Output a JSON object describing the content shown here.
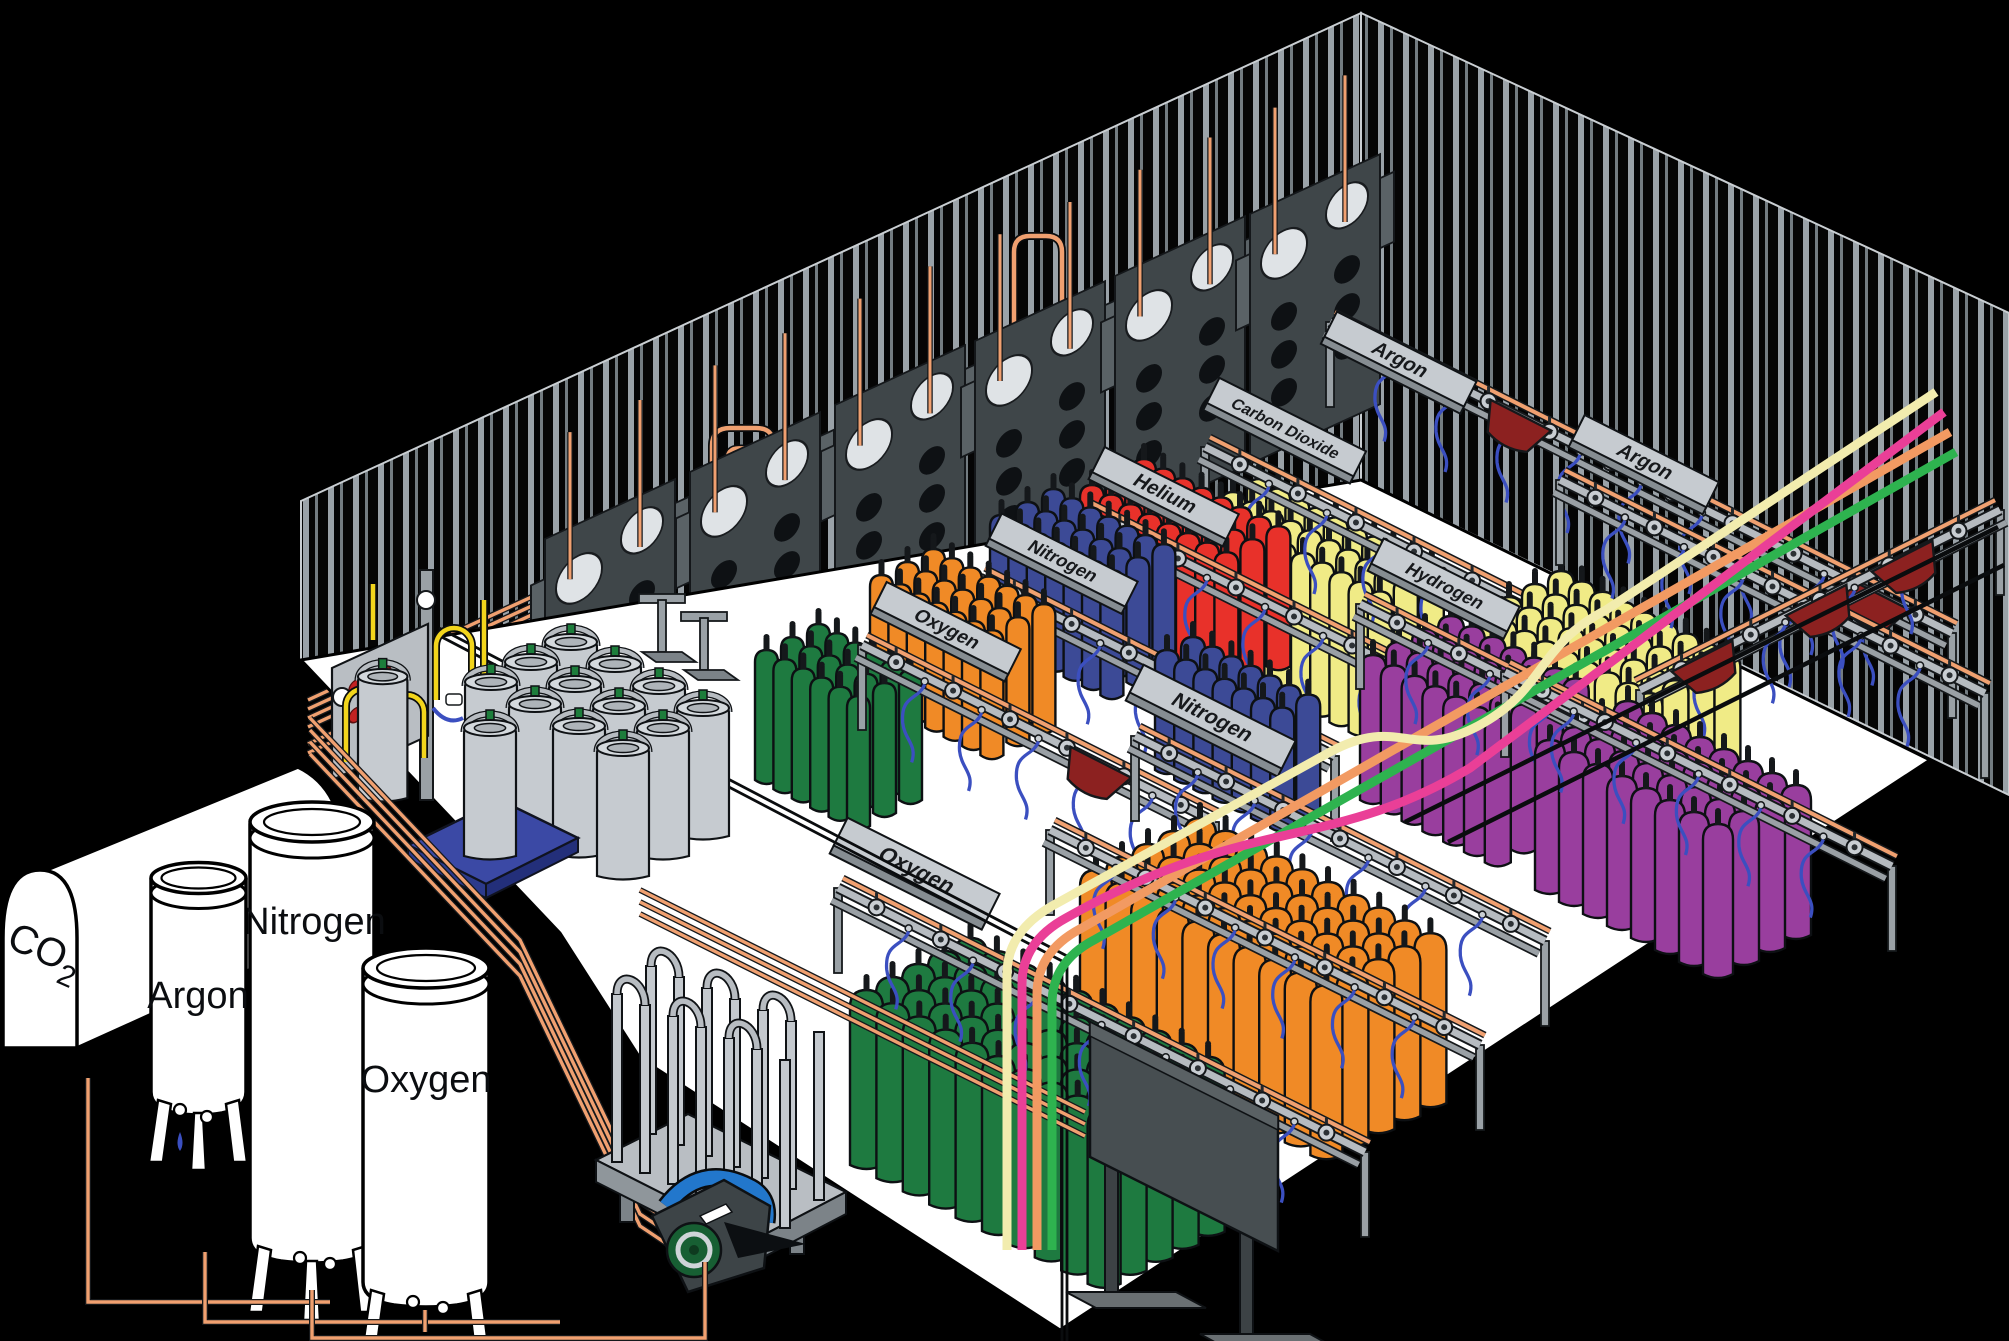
{
  "storage_tanks": {
    "co2": {
      "label_main": "CO",
      "label_sub": "2"
    },
    "argon": {
      "label": "Argon"
    },
    "nitrogen": {
      "label": "Nitrogen"
    },
    "oxygen": {
      "label": "Oxygen"
    }
  },
  "rack_signs": {
    "argon_top": {
      "label": "Argon"
    },
    "carbon_dioxide": {
      "label": "Carbon Dioxide"
    },
    "helium": {
      "label": "Helium"
    },
    "nitrogen_upper": {
      "label": "Nitrogen"
    },
    "oxygen_upper": {
      "label": "Oxygen"
    },
    "argon_right": {
      "label": "Argon"
    },
    "hydrogen": {
      "label": "Hydrogen"
    },
    "nitrogen_middle": {
      "label": "Nitrogen"
    },
    "oxygen_front": {
      "label": "Oxygen"
    }
  },
  "colors": {
    "background": "#000000",
    "floor": "#ffffff",
    "wall_stripe_light": "#9aa2a8",
    "wall_stripe_dark": "#737c81",
    "copper": "#f0a070",
    "rail_gray": "#b6bbc0",
    "hose_blue": "#3b4fc0",
    "yellow_pipe": "#f2d51c",
    "sign_plate": "#c6cbd0",
    "oxygen_green": "#1e7a40",
    "nitrogen_blue": "#3c4a96",
    "helium_red": "#e8312a",
    "co2_yellow": "#f0eb86",
    "hydrogen_purple": "#993e9e",
    "orange": "#f08a26",
    "hopper_red": "#8c2120",
    "line_cream": "#f2ecae",
    "line_pink": "#ea3f97",
    "line_salmon": "#f29a62",
    "line_green": "#2eb34f",
    "pallet_blue": "#3b49a5",
    "pump_green": "#175f33",
    "pump_blue": "#2277cc",
    "dewar_gray": "#c6cbd0",
    "panel_dark": "#3f4649"
  }
}
